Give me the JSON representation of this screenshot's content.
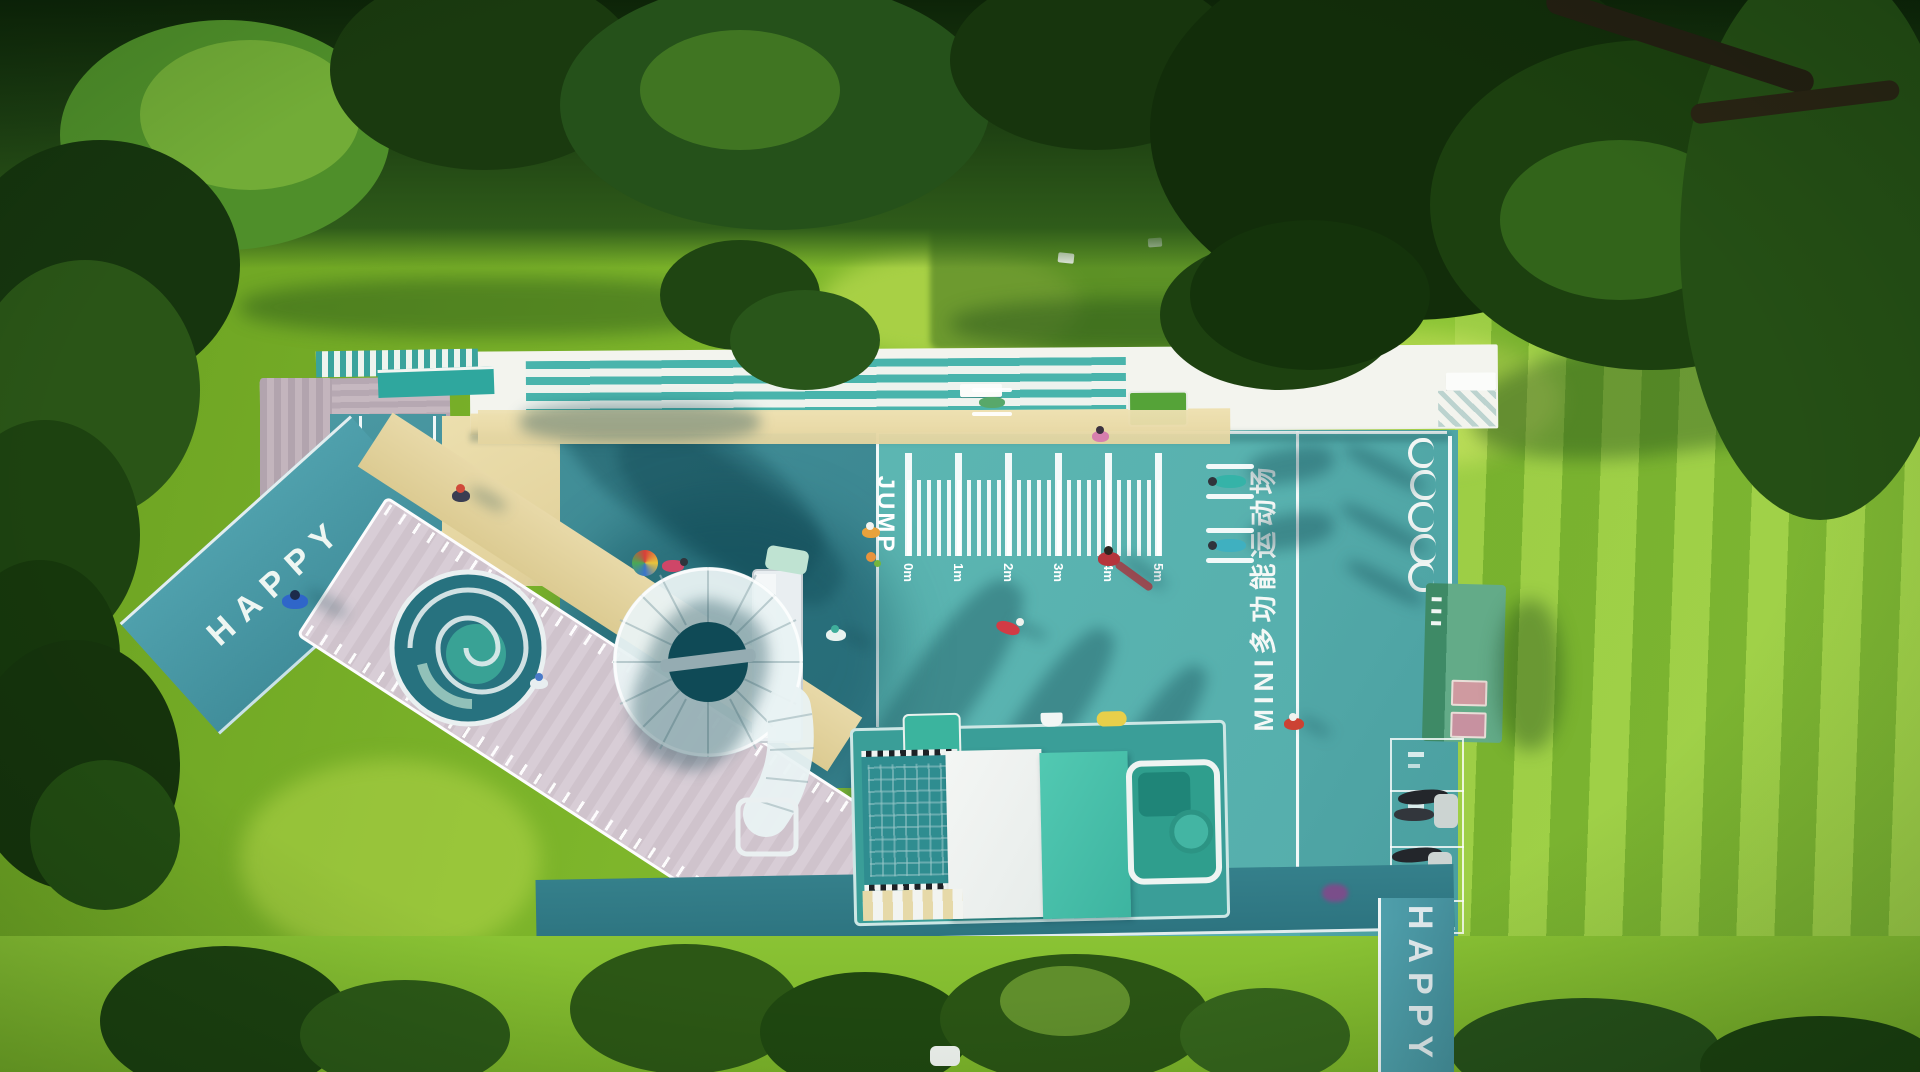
{
  "playground": {
    "entry_path": {
      "text": "HAPPY"
    },
    "exit_path": {
      "text": "HAPPY"
    },
    "jump_area": {
      "label": "JUMP",
      "ruler_labels": [
        "0m",
        "1m",
        "2m",
        "3m",
        "4m",
        "5m"
      ]
    },
    "court": {
      "banner": "MINI多功能运动场"
    },
    "walkway": {
      "chevrons": "‹‹‹‹‹"
    }
  },
  "icons": {
    "jump_marker": "flower-icon",
    "umbrella": "umbrella-icon"
  },
  "colors": {
    "grass": "#7fb62c",
    "foliage_dark": "#1e3f10",
    "court_dark_teal": "#3e8d95",
    "court_light_teal": "#5cb6b2",
    "roof_white": "#f3f4ee",
    "roof_lane_teal": "#49b4ac",
    "sand": "#e6d7a4",
    "deck_wood": "#d5cad3",
    "train_mint": "#49c3ac",
    "kiosk_green": "#57a17e",
    "marking_white": "#ffffff"
  }
}
